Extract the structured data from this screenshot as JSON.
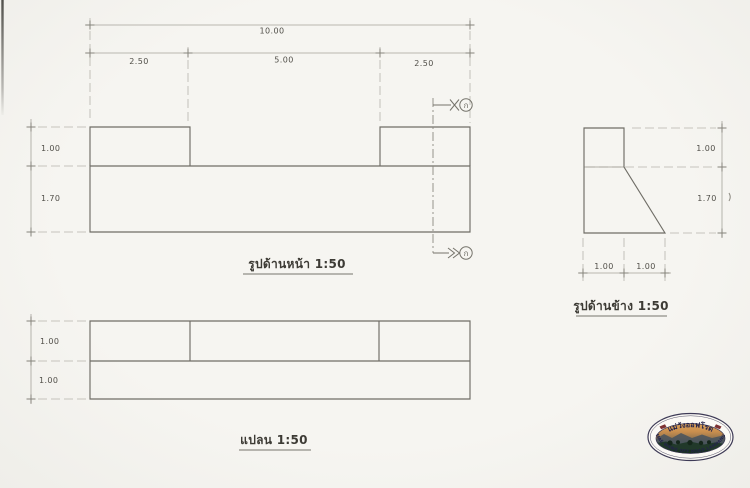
{
  "front_elevation": {
    "title": "รูปด้านหน้า 1:50",
    "dim_overall": "10.00",
    "dim_seg_left": "2.50",
    "dim_seg_mid": "5.00",
    "dim_seg_right": "2.50",
    "dim_height_top": "1.00",
    "dim_height_bottom": "1.70",
    "section_mark": "ก"
  },
  "plan": {
    "title": "แปลน 1:50",
    "dim_row_top": "1.00",
    "dim_row_bottom": "1.00"
  },
  "side_elevation": {
    "title": "รูปด้านข้าง 1:50",
    "dim_height_top": "1.00",
    "dim_height_bottom": "1.70",
    "dim_width_left": "1.00",
    "dim_width_right": "1.00"
  },
  "logo": {
    "thai_text": "แม่วังออฟโรด",
    "english_text": "MAE WANG OFF ROAD LAMPANG"
  }
}
